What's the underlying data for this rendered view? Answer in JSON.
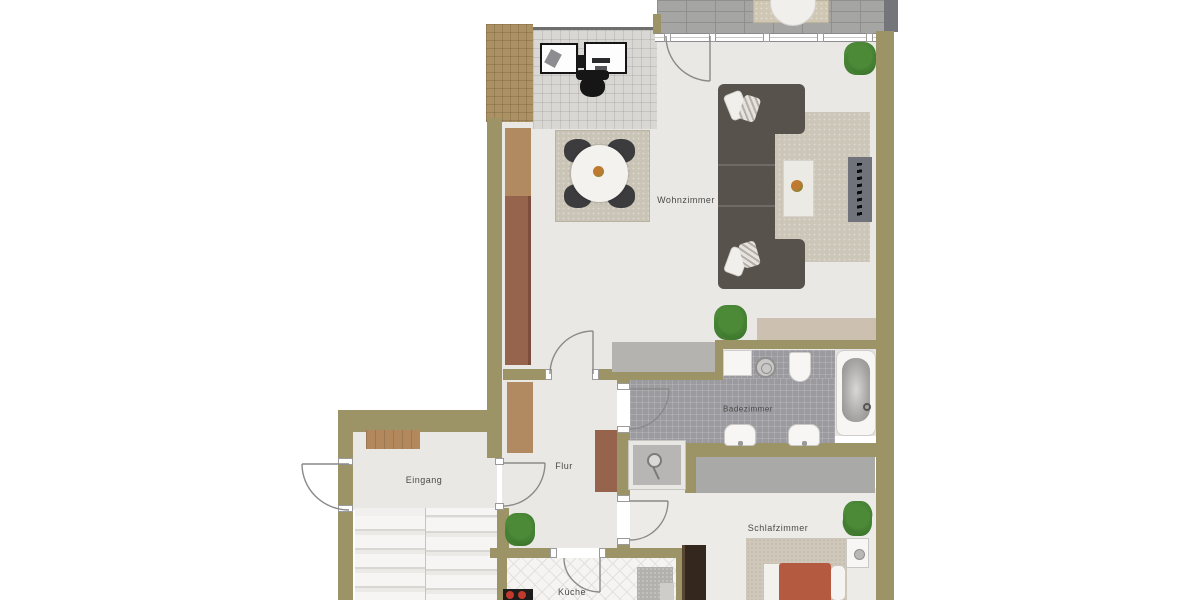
{
  "type": "floor-plan",
  "language": "de",
  "rooms": [
    {
      "id": "wohnzimmer",
      "label": "Wohnzimmer"
    },
    {
      "id": "badezimmer",
      "label": "Badezimmer"
    },
    {
      "id": "flur",
      "label": "Flur"
    },
    {
      "id": "eingang",
      "label": "Eingang"
    },
    {
      "id": "schlafzimmer",
      "label": "Schlafzimmer"
    },
    {
      "id": "kueche",
      "label": "Küche"
    }
  ],
  "palette": {
    "wall": "#9c9366",
    "floor": "#e9e8e4",
    "bedroom_floor": "#edebe7",
    "paver": "#a5a5a3",
    "window_frame": "#8b8b8b",
    "grid_tile": "#d8d7d3",
    "roof_brown": "#ab9164",
    "bath_tile": "#9b9b9f",
    "closet": "#a9a9a7",
    "stairs": "#f1f0ee",
    "stair_shadow": "#d9d7d3",
    "sofa": "#57524c",
    "rug": "#ccc6b8",
    "dining_rug": "#c9c4b6",
    "table_white": "#f3f2ef",
    "chair_dark": "#3c3c3f",
    "cabinet_light": "#b28a62",
    "cabinet_red": "#96634c",
    "gray_cabinet": "#b5b3b0",
    "sideboard": "#ccc0b1",
    "tv_panel": "#70747a",
    "fixture_white": "#f7f6f4",
    "doormat": "#b3885c",
    "wardrobe": "#34271e",
    "bed_blanket": "#cfc8ba",
    "bed_red": "#b45a40",
    "kitchen_floor": "#f5f4f2",
    "counter": "#b3b1ad",
    "stove": "#1c1c1c",
    "burner": "#c23a2c",
    "plant_green": "#4c8a38",
    "plant_dark": "#2f6423",
    "label": "#4a4a4a",
    "door_line": "#8a8a8a"
  }
}
